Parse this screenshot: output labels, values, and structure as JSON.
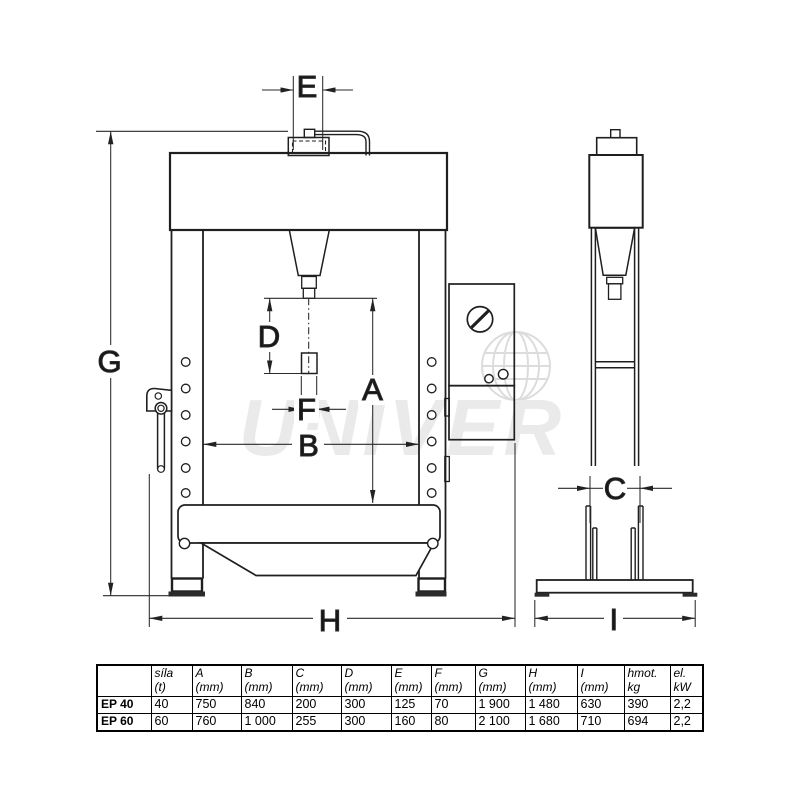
{
  "watermark": {
    "text": "UNIVER"
  },
  "dimension_labels": {
    "E": "E",
    "G": "G",
    "D": "D",
    "A": "A",
    "F": "F",
    "B": "B",
    "H": "H",
    "C": "C",
    "I": "I"
  },
  "spec_table": {
    "columns": [
      {
        "name": "",
        "unit": ""
      },
      {
        "name": "síla",
        "unit": "(t)"
      },
      {
        "name": "A",
        "unit": "(mm)"
      },
      {
        "name": "B",
        "unit": "(mm)"
      },
      {
        "name": "C",
        "unit": "(mm)"
      },
      {
        "name": "D",
        "unit": "(mm)"
      },
      {
        "name": "E",
        "unit": "(mm)"
      },
      {
        "name": "F",
        "unit": "(mm)"
      },
      {
        "name": "G",
        "unit": "(mm)"
      },
      {
        "name": "H",
        "unit": "(mm)"
      },
      {
        "name": "I",
        "unit": "(mm)"
      },
      {
        "name": "hmot.",
        "unit": "kg"
      },
      {
        "name": "el.",
        "unit": "kW"
      }
    ],
    "rows": [
      {
        "label": "EP 40",
        "values": [
          "40",
          "750",
          "840",
          "200",
          "300",
          "125",
          "70",
          "1 900",
          "1 480",
          "630",
          "390",
          "2,2"
        ]
      },
      {
        "label": "EP 60",
        "values": [
          "60",
          "760",
          "1 000",
          "255",
          "300",
          "160",
          "80",
          "2 100",
          "1 680",
          "710",
          "694",
          "2,2"
        ]
      }
    ]
  }
}
